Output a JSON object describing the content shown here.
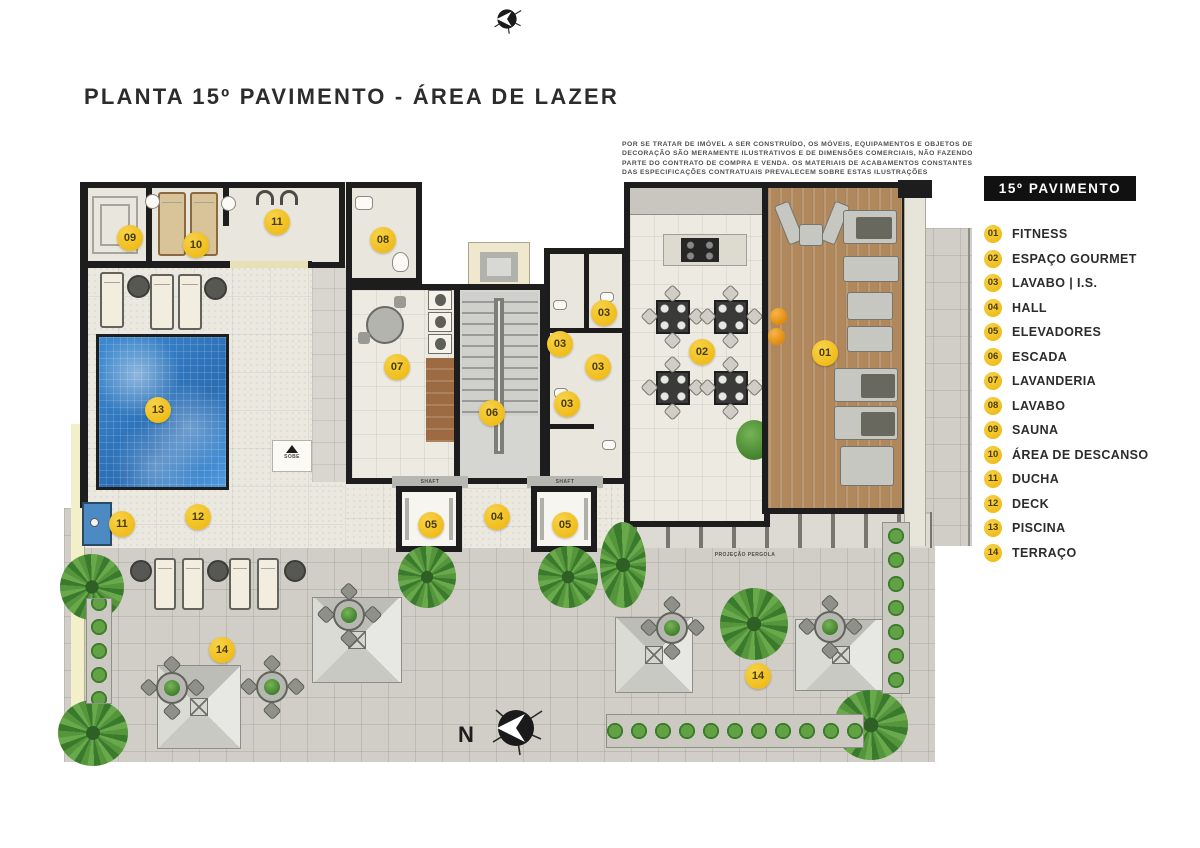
{
  "title": "PLANTA 15º PAVIMENTO - ÁREA DE LAZER",
  "disclaimer": {
    "lines": [
      "POR SE TRATAR DE IMÓVEL A SER CONSTRUÍDO, OS MÓVEIS, EQUIPAMENTOS E OBJETOS DE",
      "DECORAÇÃO SÃO MERAMENTE ILUSTRATIVOS E DE DIMENSÕES COMERCIAIS, NÃO FAZENDO",
      "PARTE DO CONTRATO DE COMPRA E VENDA. OS MATERIAIS DE ACABAMENTOS CONSTANTES",
      "DAS ESPECIFICAÇÕES CONTRATUAIS PREVALECEM SOBRE ESTAS ILUSTRAÇÕES"
    ]
  },
  "legend": {
    "header": "15º PAVIMENTO",
    "items": [
      {
        "num": "01",
        "label": "FITNESS"
      },
      {
        "num": "02",
        "label": "ESPAÇO GOURMET"
      },
      {
        "num": "03",
        "label": "LAVABO | I.S."
      },
      {
        "num": "04",
        "label": "HALL"
      },
      {
        "num": "05",
        "label": "ELEVADORES"
      },
      {
        "num": "06",
        "label": "ESCADA"
      },
      {
        "num": "07",
        "label": "LAVANDERIA"
      },
      {
        "num": "08",
        "label": "LAVABO"
      },
      {
        "num": "09",
        "label": "SAUNA"
      },
      {
        "num": "10",
        "label": "ÁREA DE DESCANSO"
      },
      {
        "num": "11",
        "label": "DUCHA"
      },
      {
        "num": "12",
        "label": "DECK"
      },
      {
        "num": "13",
        "label": "PISCINA"
      },
      {
        "num": "14",
        "label": "TERRAÇO"
      }
    ]
  },
  "plan": {
    "markers": [
      {
        "num": "09",
        "name": "sauna",
        "x": 130,
        "y": 238
      },
      {
        "num": "10",
        "name": "area-de-descanso",
        "x": 196,
        "y": 245
      },
      {
        "num": "11",
        "name": "ducha-superior",
        "x": 277,
        "y": 222
      },
      {
        "num": "08",
        "name": "lavabo",
        "x": 383,
        "y": 240
      },
      {
        "num": "07",
        "name": "lavanderia",
        "x": 397,
        "y": 367
      },
      {
        "num": "06",
        "name": "escada",
        "x": 492,
        "y": 413
      },
      {
        "num": "03",
        "name": "lavabo-is-1",
        "x": 604,
        "y": 313
      },
      {
        "num": "03",
        "name": "lavabo-is-2",
        "x": 560,
        "y": 344
      },
      {
        "num": "03",
        "name": "lavabo-is-3",
        "x": 598,
        "y": 367
      },
      {
        "num": "03",
        "name": "lavabo-is-4",
        "x": 567,
        "y": 404
      },
      {
        "num": "02",
        "name": "espaco-gourmet",
        "x": 702,
        "y": 352
      },
      {
        "num": "01",
        "name": "fitness",
        "x": 825,
        "y": 353
      },
      {
        "num": "13",
        "name": "piscina",
        "x": 158,
        "y": 410
      },
      {
        "num": "12",
        "name": "deck",
        "x": 198,
        "y": 517
      },
      {
        "num": "11",
        "name": "ducha-inferior",
        "x": 122,
        "y": 524
      },
      {
        "num": "05",
        "name": "elevador-esquerdo",
        "x": 431,
        "y": 525
      },
      {
        "num": "04",
        "name": "hall",
        "x": 497,
        "y": 517
      },
      {
        "num": "05",
        "name": "elevador-direito",
        "x": 565,
        "y": 525
      },
      {
        "num": "14",
        "name": "terraco-esquerdo",
        "x": 222,
        "y": 650
      },
      {
        "num": "14",
        "name": "terraco-direito",
        "x": 758,
        "y": 676
      }
    ],
    "labels": {
      "shaft": "SHAFT",
      "sobe": "SOBE",
      "projecao_pergola": "PROJEÇÃO PERGOLA"
    },
    "compass": {
      "north_letter": "N"
    }
  },
  "colors": {
    "marker_fill": "#F0BD1A",
    "legend_header_bg": "#111111",
    "pool_blue": "#3580C6",
    "wood_floor": "#B1875C",
    "deck_tile": "#EBE8E0",
    "terrace_tile": "#D0CEC6",
    "wall": "#1D1D1D"
  }
}
